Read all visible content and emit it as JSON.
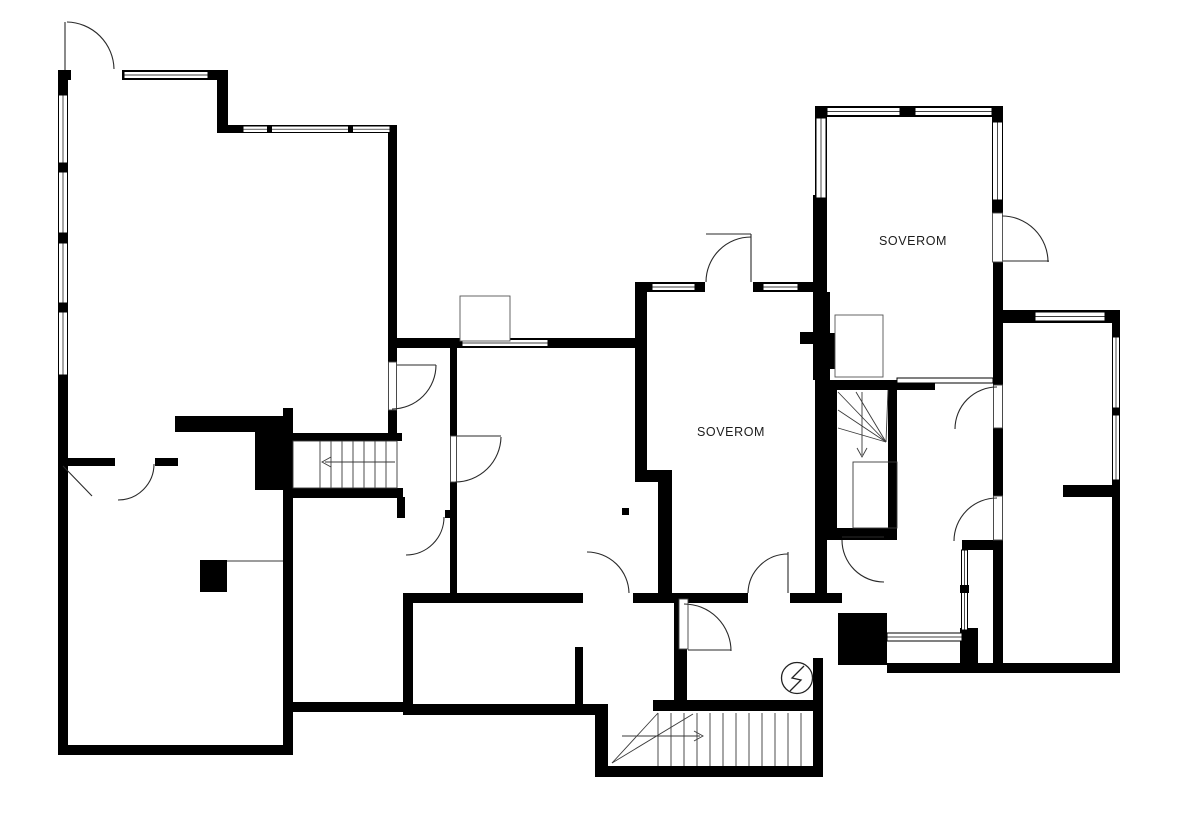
{
  "plan": {
    "type": "floor-plan",
    "background_color": "#ffffff",
    "wall_color": "#000000",
    "line_color": "#2a2a2a",
    "text_color": "#1c1c1c"
  },
  "rooms": [
    {
      "id": "bedroom-upper-right",
      "label": "SOVEROM"
    },
    {
      "id": "bedroom-middle",
      "label": "SOVEROM"
    }
  ],
  "symbols": [
    {
      "name": "electrical-panel-icon",
      "shape": "circle-with-lightning-bolt"
    },
    {
      "name": "stair-arrow-left"
    },
    {
      "name": "stair-arrow-down"
    },
    {
      "name": "stair-arrow-right"
    }
  ]
}
